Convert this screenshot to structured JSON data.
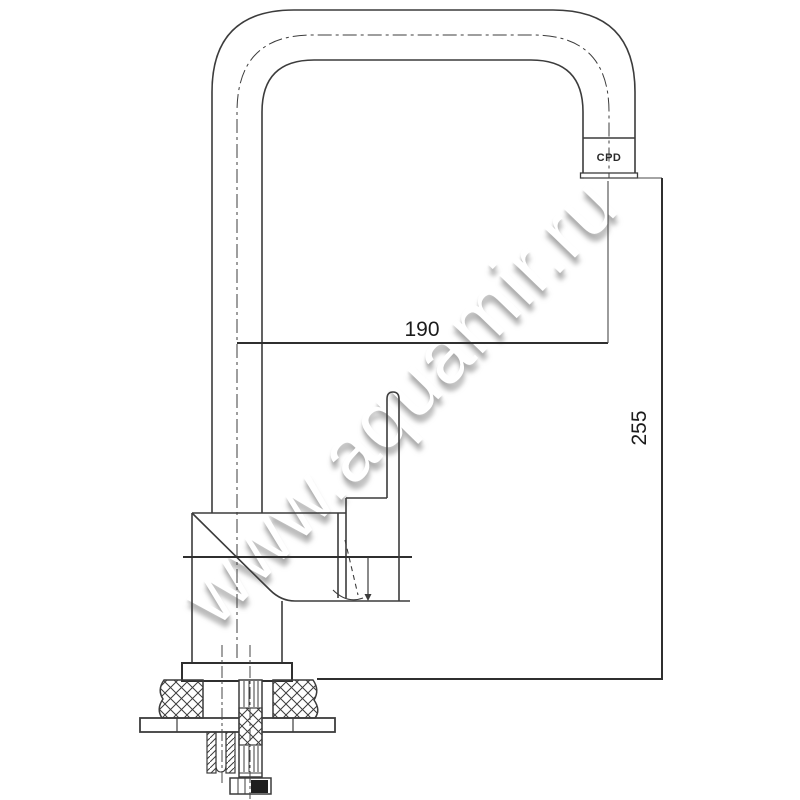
{
  "drawing": {
    "aerator_label": "CPD",
    "dimensions": {
      "spout_reach": "190",
      "spout_height": "255"
    },
    "watermark": "www.aquamir.ru",
    "colors": {
      "line": "#3c3c3c",
      "bold_line": "#2f2f2f",
      "dim_text": "#1b1b1b",
      "watermark_shadow": "#808080"
    }
  }
}
